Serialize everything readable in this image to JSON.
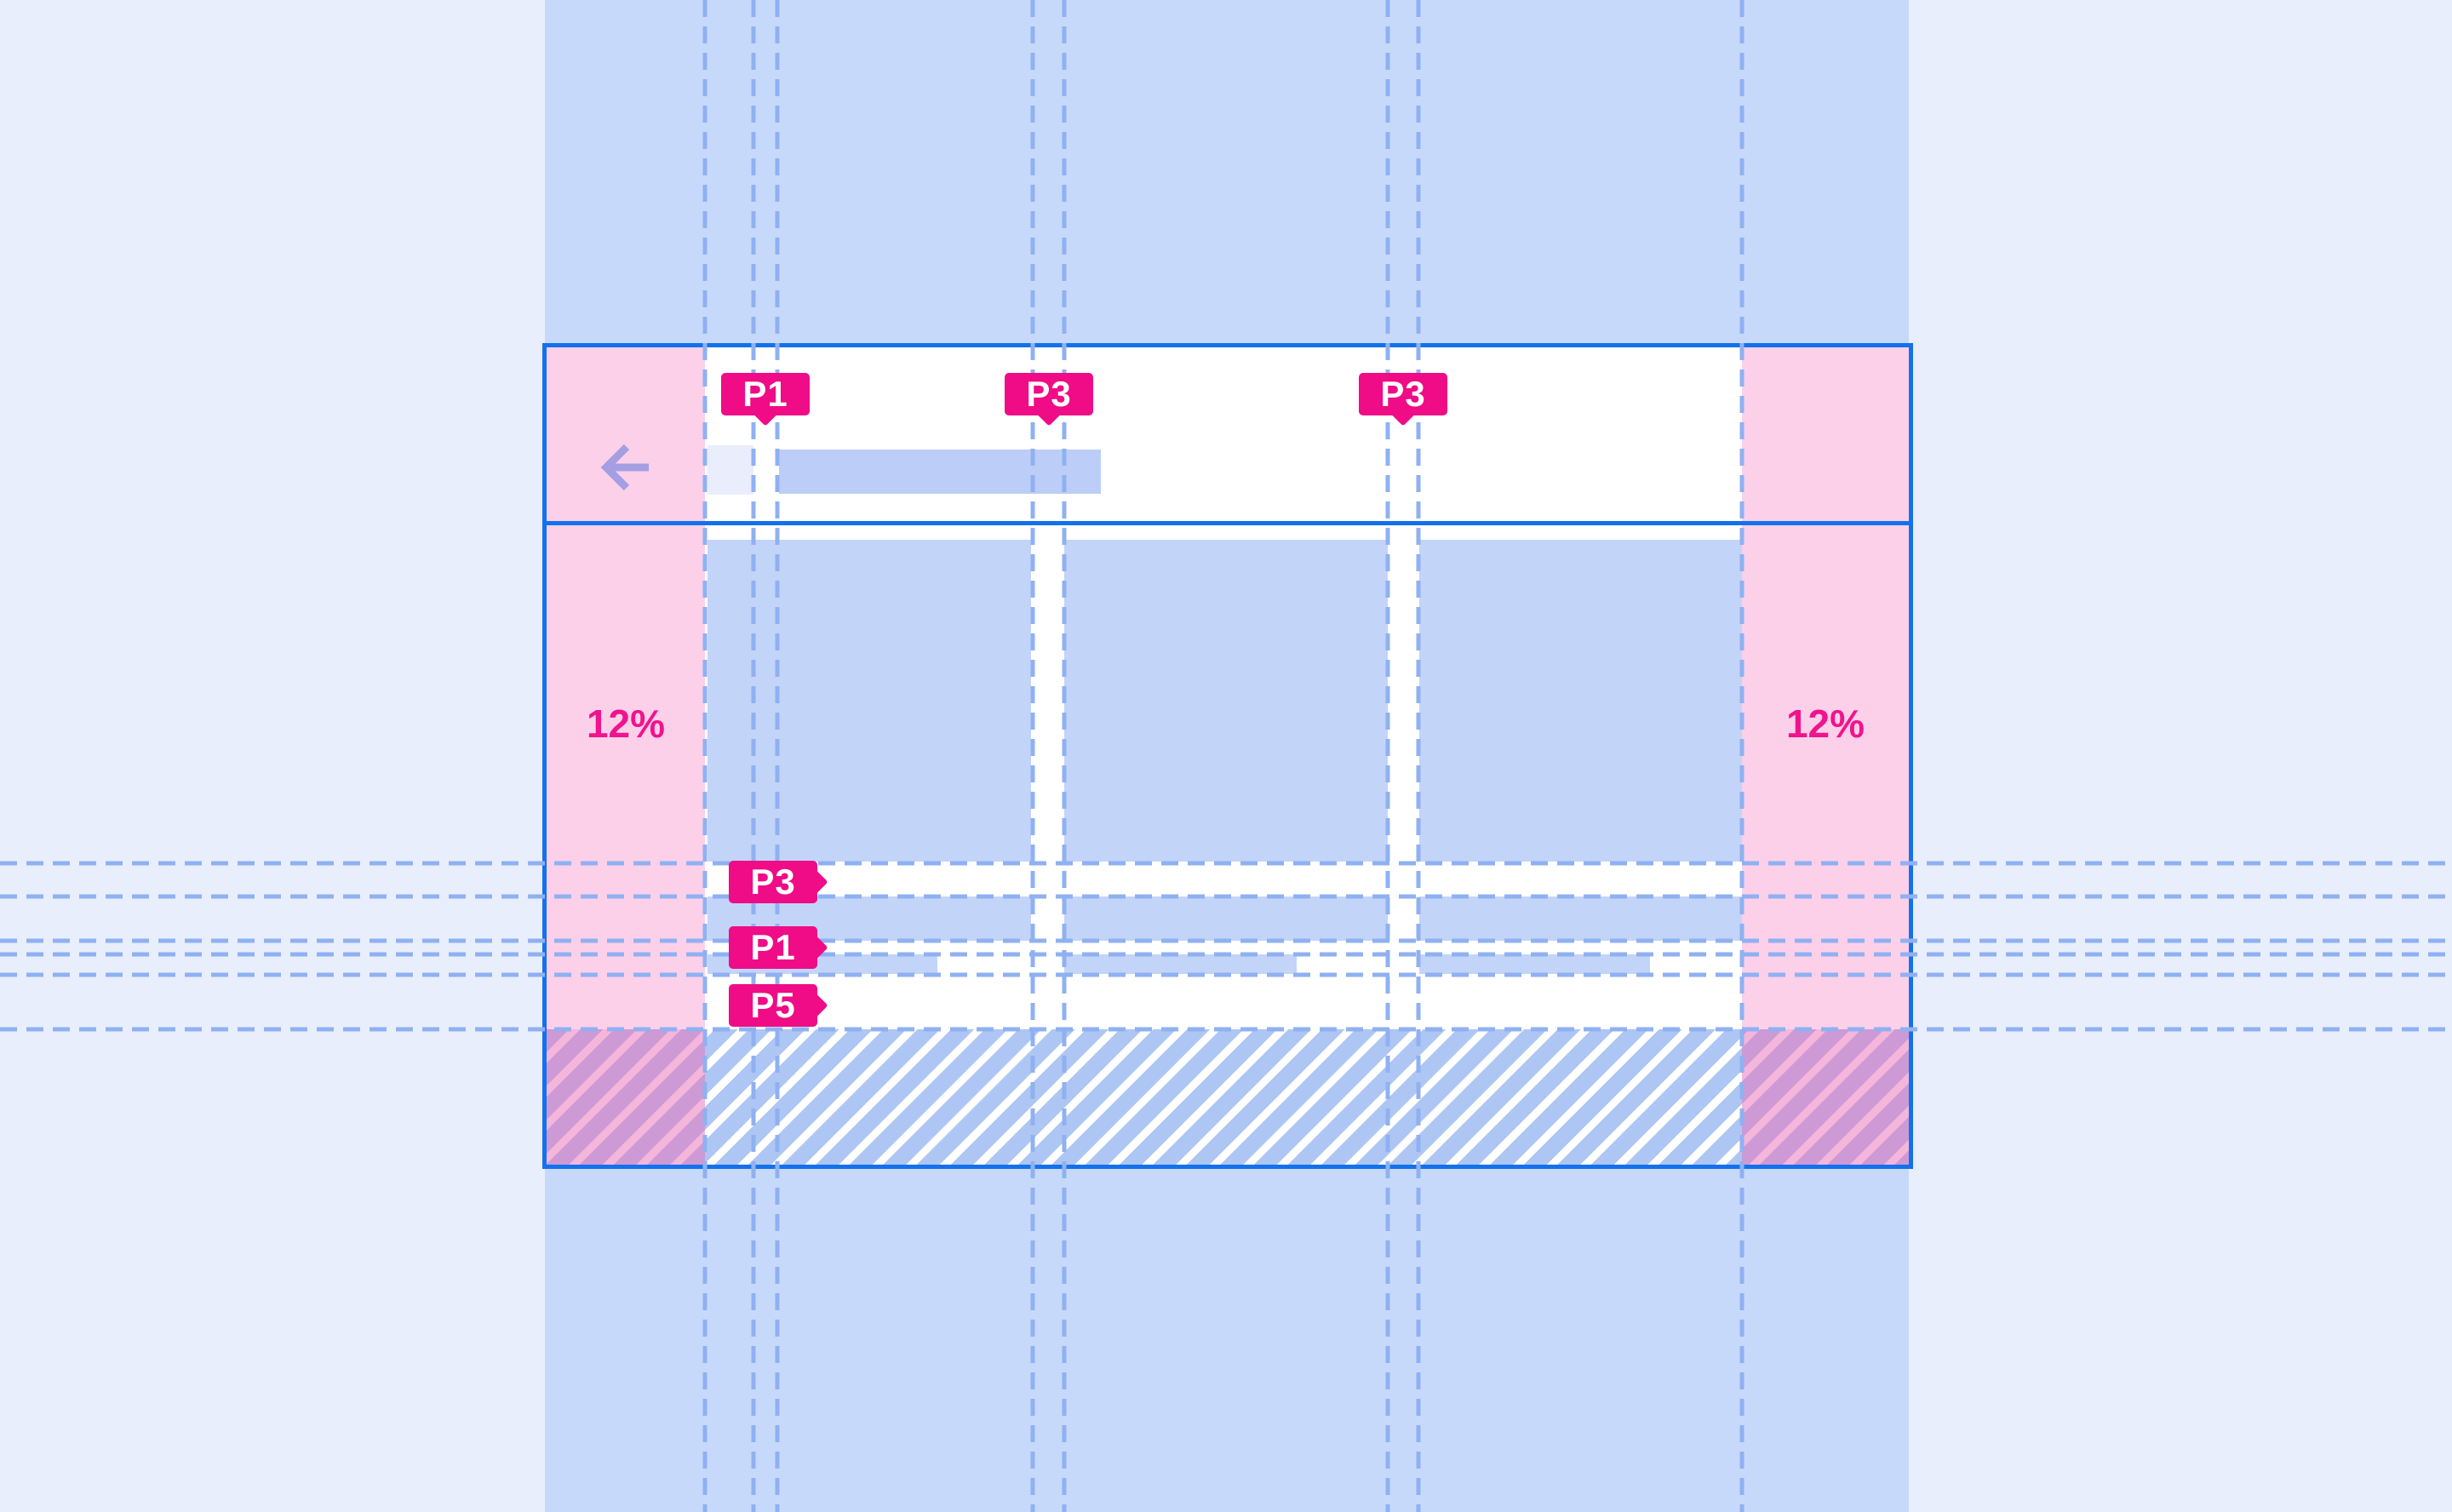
{
  "spec": {
    "top_padding_chips": [
      {
        "label": "P1"
      },
      {
        "label": "P3"
      },
      {
        "label": "P3"
      }
    ],
    "side_padding_chips": [
      {
        "label": "P3"
      },
      {
        "label": "P1"
      },
      {
        "label": "P5"
      }
    ],
    "margins": {
      "left_label": "12%",
      "right_label": "12%"
    },
    "icons": {
      "back": "arrow-back-icon"
    },
    "colors": {
      "accent_magenta": "#ef0c86",
      "margin_pink": "#fdd0e9",
      "frame_border_blue": "#1371ec",
      "surface_card_blue": "#c3d4f9",
      "title_bar_blue": "#bccdf8",
      "column_band_blue": "#c7d9fa",
      "background_lavender": "#e9eefc",
      "guide_dash_blue": "#8fb1f2",
      "hatch_blue": "#aec6f3",
      "back_arrow_purple": "#a49fe3"
    }
  }
}
